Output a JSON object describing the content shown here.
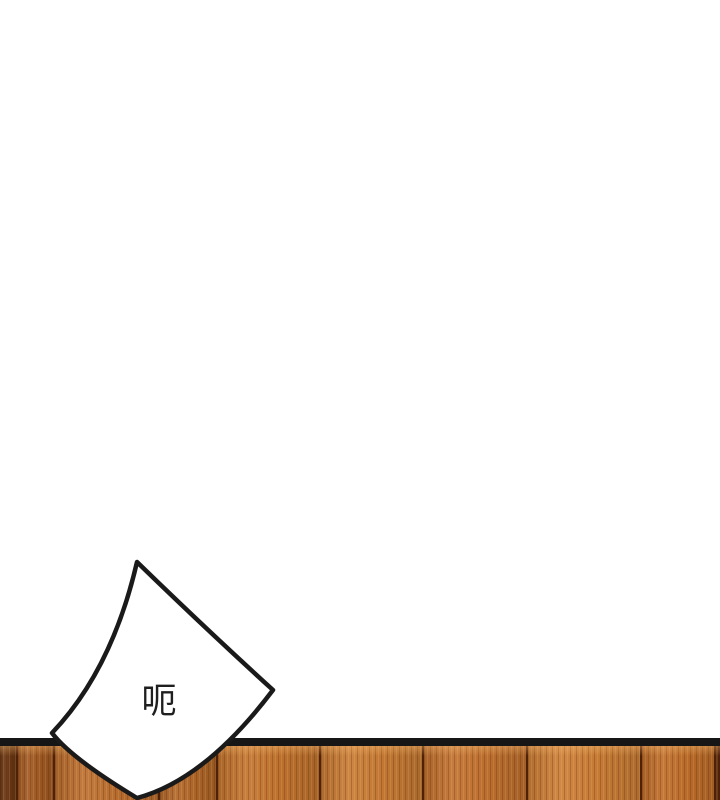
{
  "page": {
    "background_color": "#ffffff",
    "type_label": "comic-panel"
  },
  "bubble": {
    "text": "呃",
    "fill_color": "#ffffff",
    "stroke_color": "#1a1a1a",
    "text_color": "#1f1f1f"
  },
  "wood": {
    "top_line_color": "#161616",
    "separator_color": "#4e2109",
    "planks": [
      {
        "x": 0,
        "w": 18,
        "color": "#6a3714"
      },
      {
        "x": 18,
        "w": 37,
        "color": "#a25a23"
      },
      {
        "x": 55,
        "w": 105,
        "color": "#bd7030"
      },
      {
        "x": 160,
        "w": 58,
        "color": "#b2682a"
      },
      {
        "x": 218,
        "w": 103,
        "color": "#c4752f"
      },
      {
        "x": 321,
        "w": 103,
        "color": "#c97c35"
      },
      {
        "x": 424,
        "w": 104,
        "color": "#c27230"
      },
      {
        "x": 528,
        "w": 114,
        "color": "#cd7f37"
      },
      {
        "x": 642,
        "w": 74,
        "color": "#c06f2b"
      },
      {
        "x": 716,
        "w": 4,
        "color": "#77421c"
      }
    ]
  }
}
